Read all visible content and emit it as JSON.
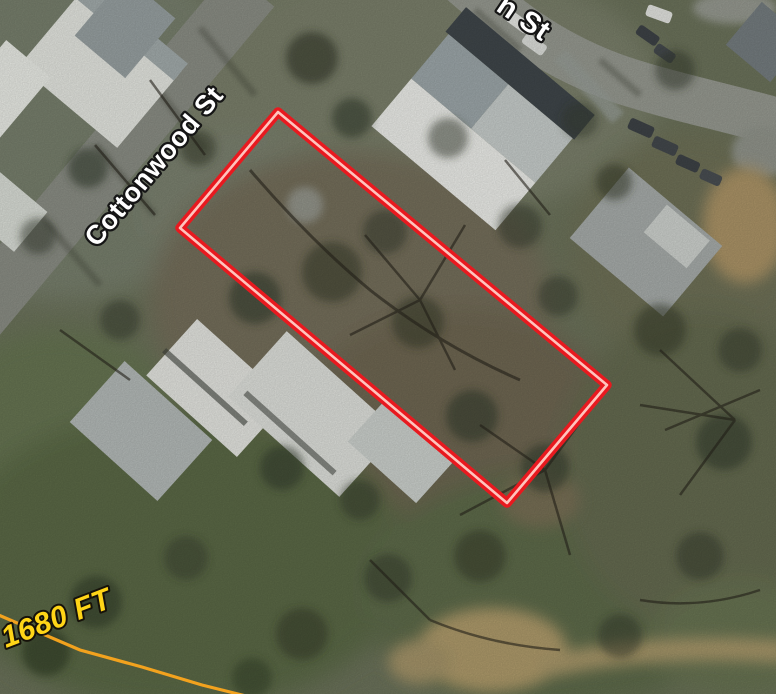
{
  "map": {
    "labels": {
      "street_cottonwood": "Cottonwood St",
      "street_partial": "n St",
      "contour_elevation": "1680 FT"
    },
    "parcel": {
      "outline_points": "278,112 180,228 507,503 607,385",
      "outline_color": "#e8191f",
      "inner_stripe_color": "#ffc4bd"
    },
    "contour": {
      "line_points": "-6,613 80,650 142,667 202,685 250,697",
      "line_color": "#f2a21e",
      "text_color": "#ffd517"
    },
    "street_label_style": {
      "text_color": "#ffffff",
      "outline_color": "#151515"
    },
    "terrain_colors": {
      "road": "#8c8f86",
      "grass": "#5b6a46",
      "dirt": "#b09c6c",
      "roof_white": "#e7e9e3",
      "roof_gray": "#9aa2a3",
      "roof_dark": "#40474b"
    }
  }
}
